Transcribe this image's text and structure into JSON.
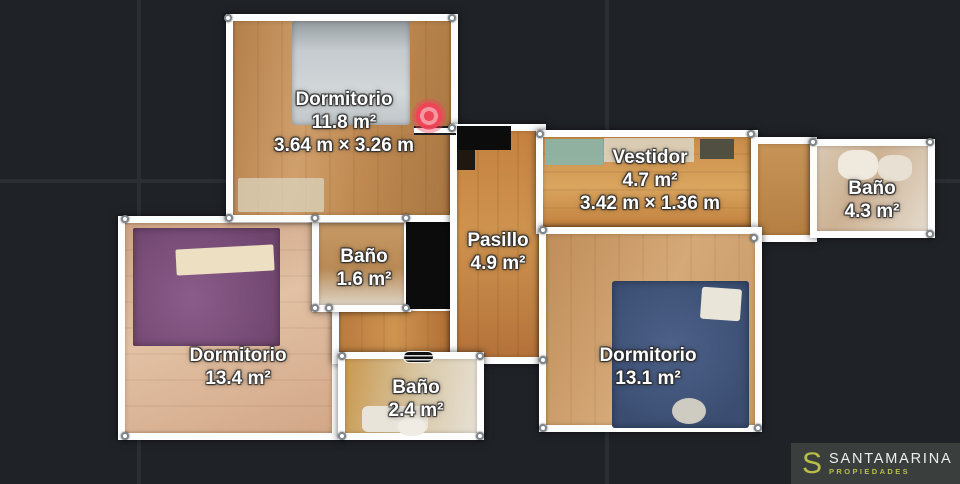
{
  "viewer": {
    "background_color": "#1f2227",
    "grid_color": "#2b2f34",
    "wall_color": "#ffffff",
    "marker_color": "#ee4458"
  },
  "floorplan": {
    "rooms": [
      {
        "id": "dormitorio-1",
        "name": "Dormitorio",
        "area": "11.8 m²",
        "dimensions": "3.64 m × 3.26 m"
      },
      {
        "id": "vestidor",
        "name": "Vestidor",
        "area": "4.7 m²",
        "dimensions": "3.42 m × 1.36 m"
      },
      {
        "id": "bano-superior",
        "name": "Baño",
        "area": "4.3 m²"
      },
      {
        "id": "bano-central",
        "name": "Baño",
        "area": "1.6 m²"
      },
      {
        "id": "pasillo",
        "name": "Pasillo",
        "area": "4.9 m²"
      },
      {
        "id": "dormitorio-2",
        "name": "Dormitorio",
        "area": "13.4 m²"
      },
      {
        "id": "bano-inferior",
        "name": "Baño",
        "area": "2.4 m²"
      },
      {
        "id": "dormitorio-3",
        "name": "Dormitorio",
        "area": "13.1 m²"
      }
    ]
  },
  "branding": {
    "logo_letter": "S",
    "company": "SANTAMARINA",
    "tagline": "PROPIEDADES",
    "accent_color": "#b9be48"
  }
}
